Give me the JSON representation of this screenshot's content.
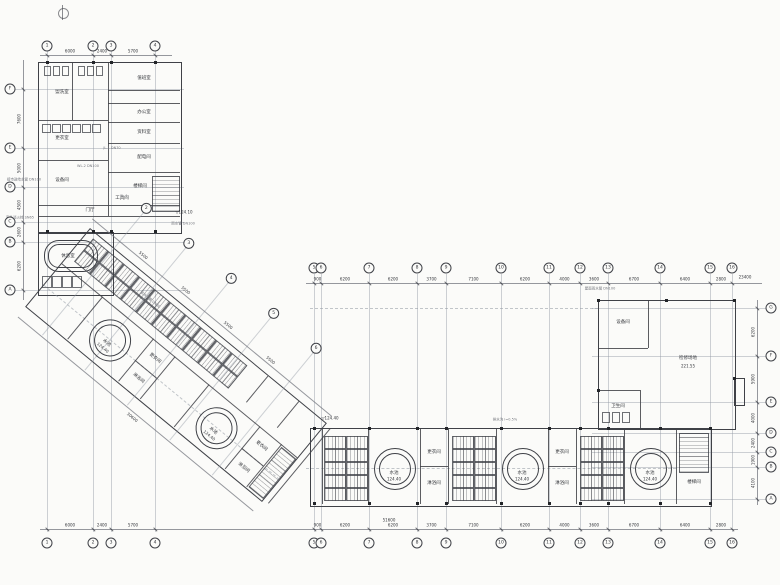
{
  "canvas": {
    "paper": "#fbfbf9",
    "line": "#3f4147",
    "grid": "#9299a3",
    "text": "#34363b",
    "muted": "#73767d"
  },
  "axes": {
    "top": {
      "labels": [
        "1",
        "2",
        "3",
        "4"
      ],
      "dims": [
        "6000",
        "2400",
        "5700"
      ]
    },
    "mid": {
      "labels": [
        "5",
        "6",
        "7",
        "8",
        "9",
        "10",
        "11",
        "12",
        "13",
        "14",
        "15",
        "16"
      ],
      "dims": [
        "900",
        "6200",
        "6200",
        "3700",
        "7100",
        "6200",
        "4000",
        "3600",
        "6700",
        "6400",
        "2800"
      ],
      "total": "23400"
    },
    "bottom": {
      "labels": [
        "1",
        "2",
        "3",
        "4",
        "5",
        "6",
        "7",
        "8",
        "9",
        "10",
        "11",
        "12",
        "13",
        "14",
        "15",
        "16"
      ],
      "dims": [
        "6000",
        "2400",
        "5700",
        "",
        "900",
        "6200",
        "6200",
        "3700",
        "7100",
        "6200",
        "4000",
        "3600",
        "6700",
        "6400",
        "2800"
      ],
      "total": "51600"
    },
    "left": {
      "labels": [
        "F",
        "E",
        "D",
        "C",
        "B",
        "A"
      ],
      "dims": [
        "7600",
        "5000",
        "4500",
        "2600",
        "6200"
      ]
    },
    "right": {
      "labels": [
        "G",
        "F",
        "E",
        "D",
        "C",
        "B",
        "A"
      ],
      "dims": [
        "6200",
        "5900",
        "4000",
        "2400",
        "1900",
        "4100"
      ]
    },
    "diag": {
      "labels": [
        "2",
        "3",
        "4",
        "5",
        "6"
      ],
      "dims": [
        "5500",
        "5500",
        "5500",
        "5500"
      ],
      "total": "30600"
    }
  },
  "room_labels": [
    "盥洗室",
    "更衣室",
    "设备间",
    "值班室",
    "门厅",
    "休息室",
    "办公室",
    "资料室",
    "配电间",
    "工具间",
    "楼梯间",
    "更衣间",
    "淋浴间",
    "更衣间",
    "淋浴间",
    "更衣间",
    "淋浴间",
    "更衣间",
    "淋浴间",
    "楼梯间",
    "设备间",
    "卫生间"
  ],
  "pool": {
    "name": "水池",
    "elev": "124.40"
  },
  "right_block": {
    "name": "检修场地",
    "elev": "221.55"
  },
  "annotations": [
    "接市政给水管 DN100",
    "室外消火栓 SN65",
    "雨水管 DN100",
    "排水沟 i=0.5%",
    "屋面雨水管 DN100",
    "JL-1 DN70",
    "WL-2 DN100",
    "给水干管 DN80",
    "FL-1"
  ],
  "elevation_marks": [
    "▽124.10",
    "▽124.40"
  ]
}
